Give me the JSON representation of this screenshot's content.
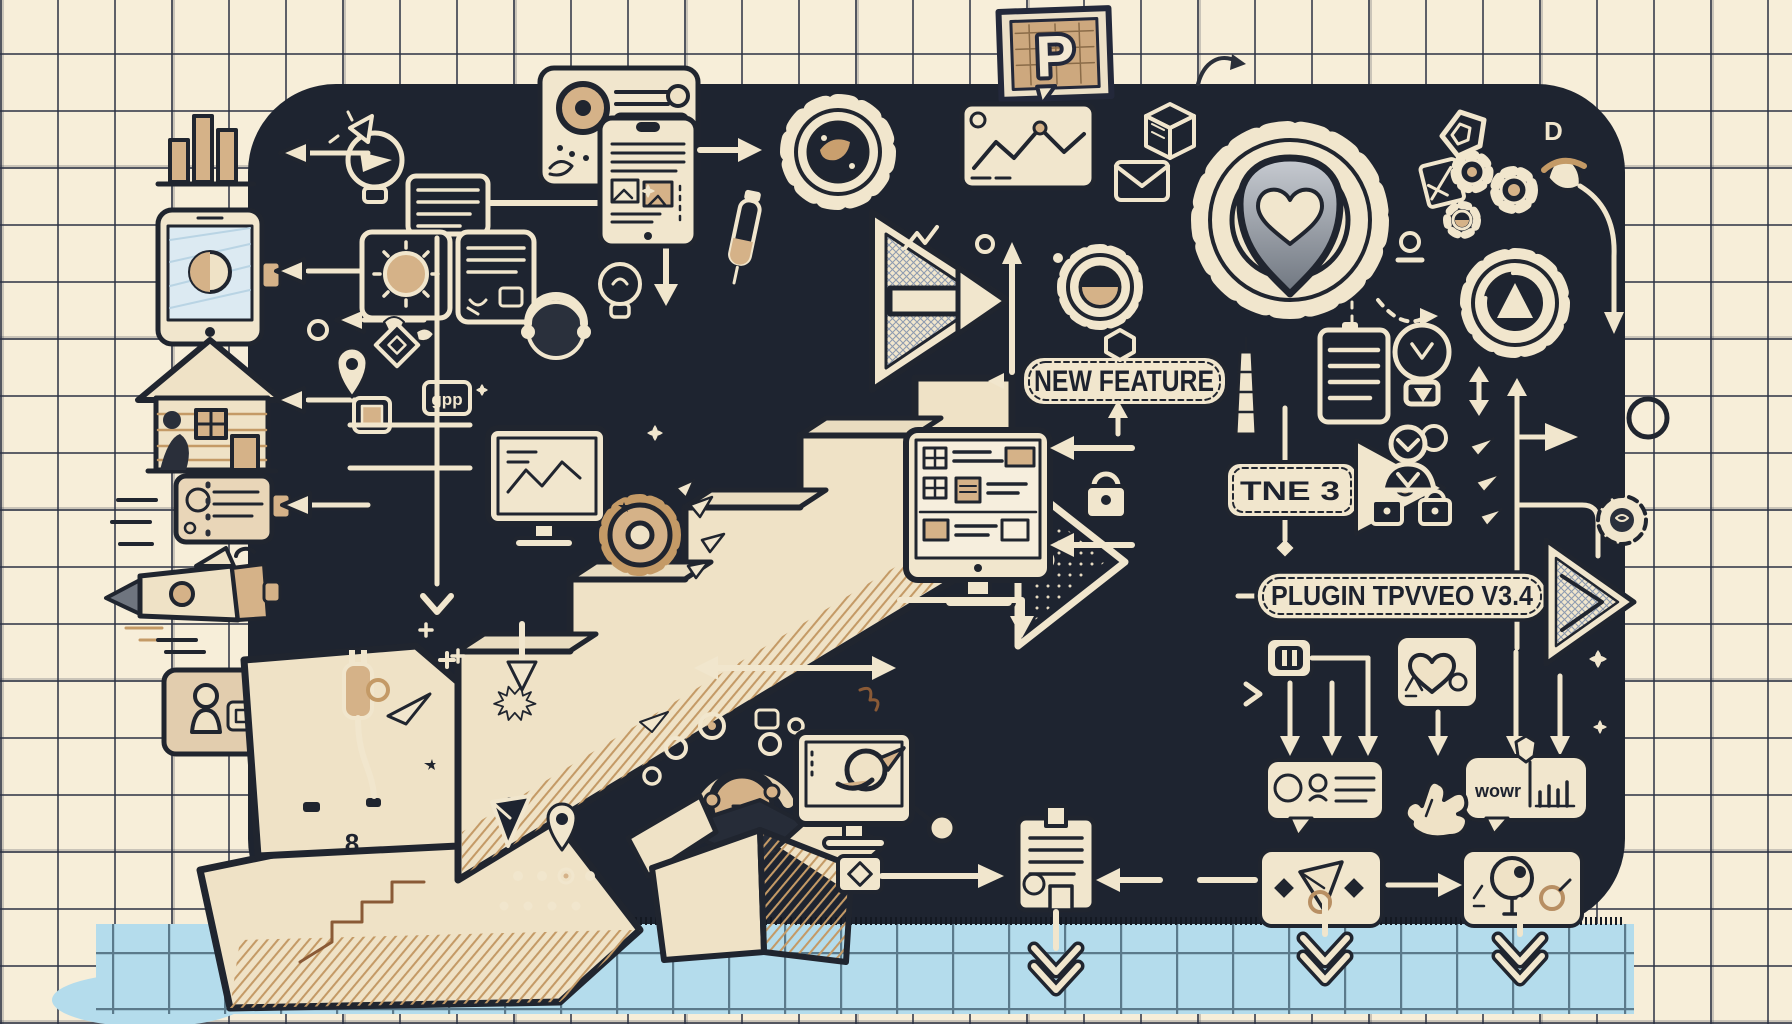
{
  "title": "Plugin update roadmap doodle illustration",
  "colors": {
    "paper": "#f7eed9",
    "grid_line": "#2b3142",
    "panel": "#1e2430",
    "doodle_ink": "#f1e6cd",
    "dark_ink": "#20252f",
    "tan_accent": "#d5b288",
    "floor_blue": "#b4dcec",
    "shield_gray": "#8d939d"
  },
  "labels": {
    "logo_badge": "P",
    "new_feature_sign": "NEW FEATURE",
    "tne_arrow_badge": "TNE 3",
    "plugin_banner": "PLUGIN TPVVEO V3.4",
    "gpp_tag": "gpp",
    "wow_bubble": "wowr",
    "letter_d": "D",
    "step_number": "8"
  },
  "icon_names": [
    "bar-chart-icon",
    "tablet-icon",
    "house-icon",
    "id-card-icon",
    "rocket-icon",
    "user-card-icon",
    "p-logo-badge",
    "swoosh-arrow-icon",
    "search-card-icon",
    "document-tablet-icon",
    "gear-photo-icon",
    "line-chart-card-icon",
    "envelope-icon",
    "cube-icon",
    "gear-heart-icon",
    "gear-contrast-icon",
    "gear-triangle-icon",
    "lightbulb-icon",
    "lightbulb-rocket-icon",
    "sun-card-icon",
    "notes-card-icon",
    "monitor-list-icon",
    "monitor-sketch-icon",
    "monitor-bird-icon",
    "open-box-icon",
    "gear-burst-icon",
    "staircase",
    "big-arrow-right",
    "wedge-arrow",
    "lock-icon",
    "padlock-icon",
    "person-shield-icon",
    "document-icon",
    "paper-plane-icon",
    "map-pin-icon",
    "diamond-icon",
    "headset-person-icon",
    "dropper-icon",
    "plug-cable-icon",
    "pause-chip-icon",
    "heart-card-icon",
    "speech-bubble-card",
    "hand-cursor-icon",
    "envelope-kite-card",
    "balloon-person-card",
    "clipboard-icon",
    "chevron-down-arrow",
    "sparkle-icon",
    "acorn-icon",
    "pentagon-shield-icon",
    "flower-gear-icon"
  ]
}
